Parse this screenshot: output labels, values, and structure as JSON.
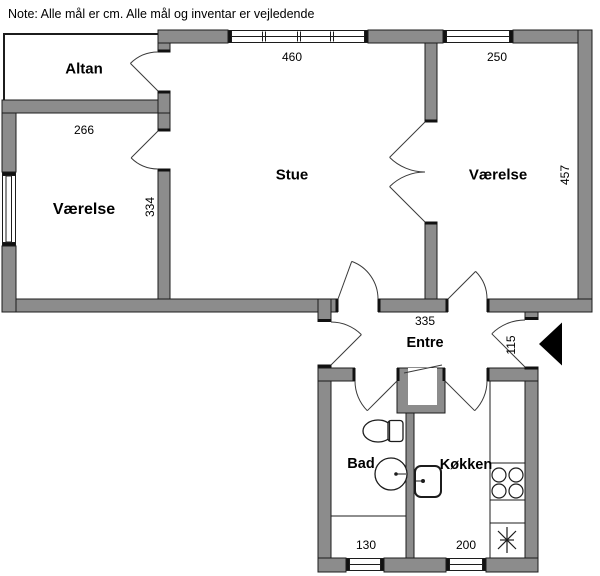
{
  "note": "Note: Alle mål er cm. Alle mål og inventar er vejledende",
  "rooms": {
    "altan": {
      "label": "Altan"
    },
    "vaerelse_left": {
      "label": "Værelse",
      "width": "266",
      "depth": "334"
    },
    "stue": {
      "label": "Stue",
      "width": "460"
    },
    "vaerelse_right": {
      "label": "Værelse",
      "width": "250",
      "depth": "457"
    },
    "entre": {
      "label": "Entre",
      "width": "335",
      "entry": "115"
    },
    "bad": {
      "label": "Bad",
      "width": "130"
    },
    "koekken": {
      "label": "Køkken",
      "width": "200"
    }
  },
  "colors": {
    "wall": "#8c8c8c",
    "line": "#1c1c1c",
    "background": "#ffffff"
  }
}
